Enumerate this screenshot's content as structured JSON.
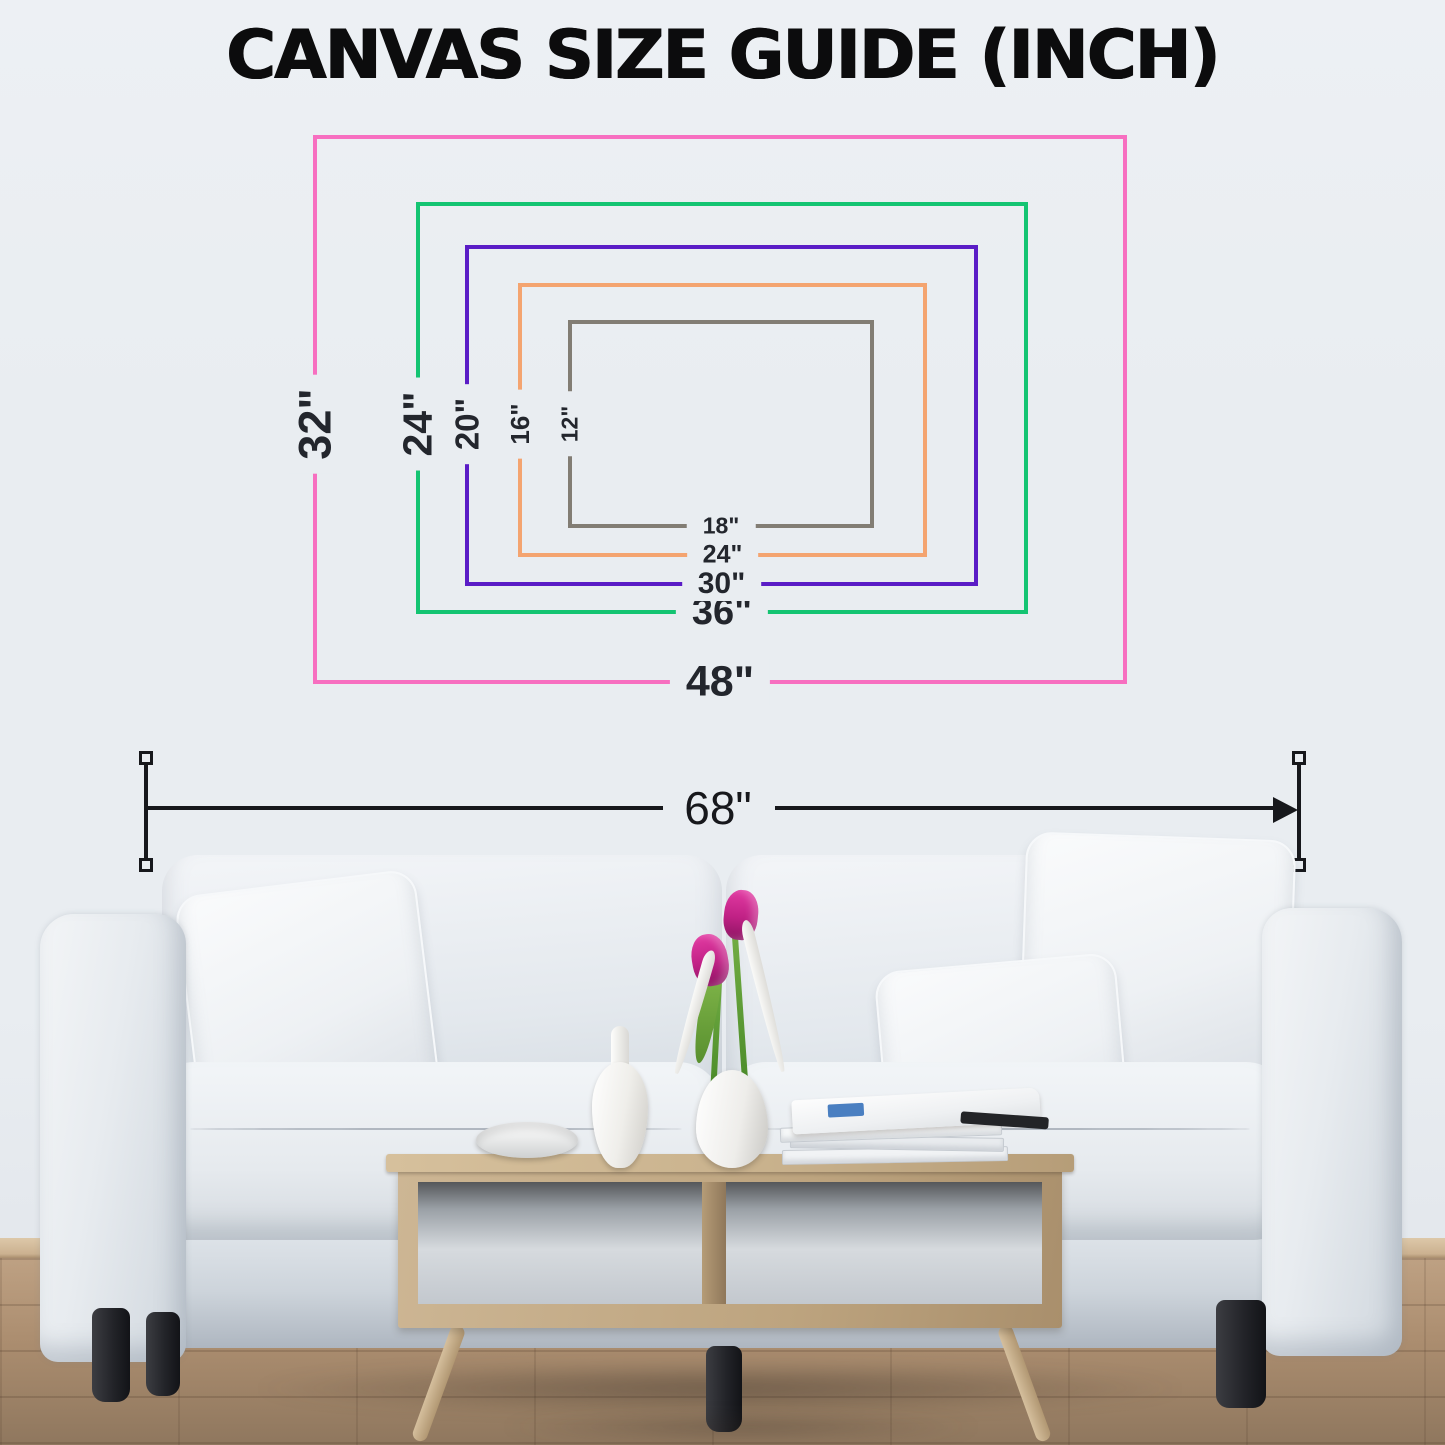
{
  "title": "CANVAS SIZE GUIDE (INCH)",
  "guide": {
    "sizes": [
      {
        "name": "48x32",
        "width_label": "48\"",
        "height_label": "32\"",
        "color": "#f76fc0"
      },
      {
        "name": "36x24",
        "width_label": "36\"",
        "height_label": "24\"",
        "color": "#14c472"
      },
      {
        "name": "30x20",
        "width_label": "30\"",
        "height_label": "20\"",
        "color": "#5a1cc6"
      },
      {
        "name": "24x16",
        "width_label": "24\"",
        "height_label": "16\"",
        "color": "#f4a470"
      },
      {
        "name": "18x12",
        "width_label": "18\"",
        "height_label": "12\"",
        "color": "#827d74"
      }
    ],
    "wall_span_label": "68\"",
    "dimension_color": "#17181c",
    "label_color": "#23262d"
  },
  "scene": {
    "wall_color": "#e9edf1",
    "floor_color": "#ab8d6f",
    "baseboard_color": "#cbb190",
    "sofa_color": "#e9edf0",
    "sofa_leg_color": "#232429",
    "table_color": "#c9b28d",
    "tulip_color": "#c02185",
    "stem_color": "#588f2e"
  }
}
